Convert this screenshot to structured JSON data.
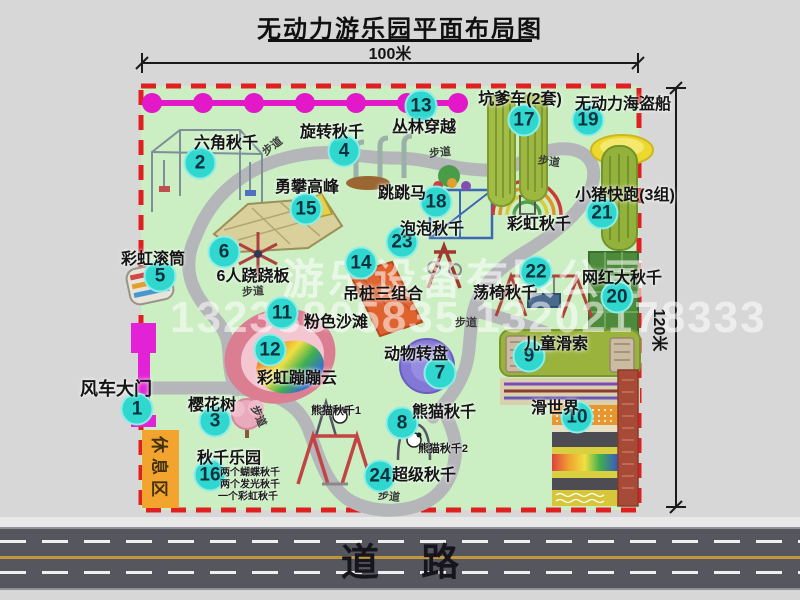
{
  "title": "无动力游乐园平面布局图",
  "dimensions": {
    "width_label": "100米",
    "height_label": "120米"
  },
  "road_label": "道    路",
  "rest_area_label": "休息区",
  "watermark": {
    "line1": "游乐设备有限公司",
    "line2": "13233805835 13202178333"
  },
  "colors": {
    "map_green": "#cbeec3",
    "border_red": "#e02020",
    "badge_teal": "#2fd7ce",
    "gate_magenta": "#e321d6",
    "rest_orange": "#f2a42e",
    "road_gray": "#56565e"
  },
  "pois": [
    {
      "num": "1",
      "label": "风车大门",
      "bx": 137,
      "by": 409,
      "lx": 116,
      "ly": 388,
      "fs": 18
    },
    {
      "num": "2",
      "label": "六角秋千",
      "bx": 200,
      "by": 163,
      "lx": 226,
      "ly": 141
    },
    {
      "num": "3",
      "label": "樱花树",
      "bx": 215,
      "by": 421,
      "lx": 212,
      "ly": 403
    },
    {
      "num": "4",
      "label": "旋转秋千",
      "bx": 344,
      "by": 151,
      "lx": 332,
      "ly": 130
    },
    {
      "num": "5",
      "label": "彩虹滚筒",
      "bx": 160,
      "by": 276,
      "lx": 153,
      "ly": 257
    },
    {
      "num": "6",
      "label": "6人跷跷板",
      "bx": 224,
      "by": 252,
      "lx": 253,
      "ly": 274
    },
    {
      "num": "7",
      "label": "动物转盘",
      "bx": 440,
      "by": 373,
      "lx": 416,
      "ly": 352
    },
    {
      "num": "8",
      "label": "熊猫秋千",
      "bx": 402,
      "by": 423,
      "lx": 444,
      "ly": 410
    },
    {
      "num": "9",
      "label": "儿童滑索",
      "bx": 529,
      "by": 356,
      "lx": 556,
      "ly": 342
    },
    {
      "num": "10",
      "label": "滑世界",
      "bx": 577,
      "by": 417,
      "lx": 555,
      "ly": 406
    },
    {
      "num": "11",
      "label": "粉色沙滩",
      "bx": 282,
      "by": 313,
      "lx": 336,
      "ly": 320
    },
    {
      "num": "12",
      "label": "彩虹蹦蹦云",
      "bx": 270,
      "by": 350,
      "lx": 297,
      "ly": 376
    },
    {
      "num": "13",
      "label": "丛林穿越",
      "bx": 421,
      "by": 106,
      "lx": 424,
      "ly": 125
    },
    {
      "num": "14",
      "label": "吊桩三组合",
      "bx": 361,
      "by": 263,
      "lx": 383,
      "ly": 292
    },
    {
      "num": "15",
      "label": "勇攀高峰",
      "bx": 306,
      "by": 209,
      "lx": 307,
      "ly": 185
    },
    {
      "num": "16",
      "label": "秋千乐园",
      "bx": 210,
      "by": 475,
      "lx": 229,
      "ly": 456
    },
    {
      "num": "17",
      "label": "坑爹车(2套)",
      "bx": 524,
      "by": 120,
      "lx": 520,
      "ly": 97
    },
    {
      "num": "18",
      "label": "跳跳马",
      "bx": 436,
      "by": 202,
      "lx": 402,
      "ly": 191
    },
    {
      "num": "19",
      "label": "无动力海盗船",
      "bx": 588,
      "by": 120,
      "lx": 623,
      "ly": 102
    },
    {
      "num": "20",
      "label": "网红大秋千",
      "bx": 617,
      "by": 297,
      "lx": 622,
      "ly": 276
    },
    {
      "num": "21",
      "label": "小猪快跑(3组)",
      "bx": 602,
      "by": 213,
      "lx": 625,
      "ly": 193
    },
    {
      "num": "22",
      "label": "荡椅秋千",
      "bx": 536,
      "by": 272,
      "lx": 505,
      "ly": 291
    },
    {
      "num": "23",
      "label": "泡泡秋千",
      "bx": 402,
      "by": 242,
      "lx": 432,
      "ly": 227
    },
    {
      "num": "24",
      "label": "超级秋千",
      "bx": 380,
      "by": 476,
      "lx": 424,
      "ly": 473
    },
    {
      "num": "",
      "label": "彩虹秋千",
      "bx": 0,
      "by": 0,
      "lx": 539,
      "ly": 222
    }
  ],
  "path_labels": [
    {
      "t": "步道",
      "x": 272,
      "y": 146,
      "r": -38
    },
    {
      "t": "步道",
      "x": 440,
      "y": 152,
      "r": -6
    },
    {
      "t": "步道",
      "x": 549,
      "y": 161,
      "r": 8
    },
    {
      "t": "步道",
      "x": 253,
      "y": 291,
      "r": -4
    },
    {
      "t": "步道",
      "x": 466,
      "y": 322,
      "r": 0
    },
    {
      "t": "步道",
      "x": 259,
      "y": 416,
      "r": 66
    },
    {
      "t": "步道",
      "x": 389,
      "y": 496,
      "r": 6
    }
  ],
  "sub_labels": [
    {
      "t": "熊猫秋千1",
      "x": 336,
      "y": 410,
      "s": 11
    },
    {
      "t": "熊猫秋千2",
      "x": 443,
      "y": 448,
      "s": 11
    },
    {
      "t": "两个蝴蝶秋千",
      "x": 250,
      "y": 471,
      "s": 10
    },
    {
      "t": "两个发光秋千",
      "x": 250,
      "y": 483,
      "s": 10
    },
    {
      "t": "一个彩虹秋千",
      "x": 248,
      "y": 495,
      "s": 10
    }
  ]
}
